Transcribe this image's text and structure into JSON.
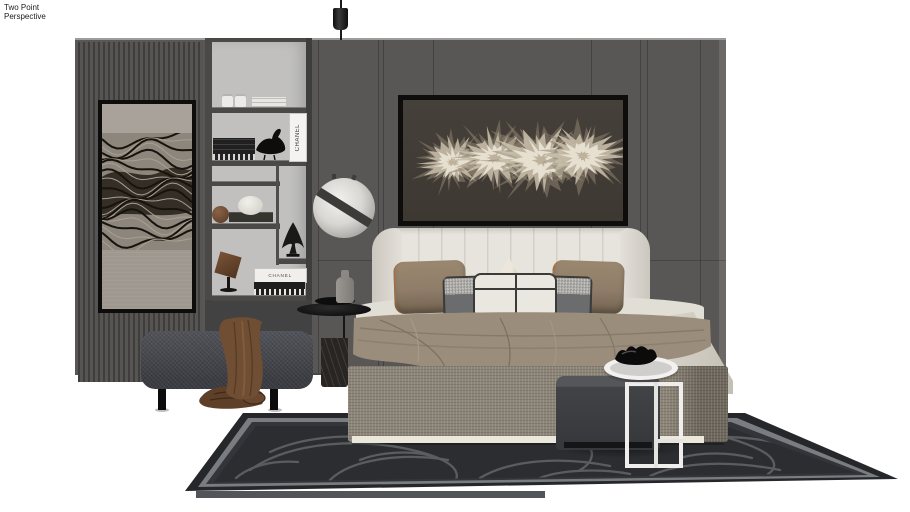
{
  "camera_label": {
    "line1": "Two Point",
    "line2": "Perspective"
  },
  "decor_text": {
    "book_spine_vertical": "CHANEL",
    "book_stack_spine": "CHANEL"
  },
  "palette": {
    "floor": "#ffffff",
    "wall": "#585756",
    "wall_edge": "#6b6a69",
    "rib_dark": "#3f3e3d",
    "rib_light": "#565554",
    "shelf_back": "#c1c0bf",
    "shelf_frame": "#4a4948",
    "art_frame": "#0e0d0c",
    "art_bg": "#3e3832",
    "art_petal_outer": "#8e8270",
    "art_petal_mid": "#c9bfab",
    "art_petal_core": "#e9e2d2",
    "headboard": "#e7e4dd",
    "pillow_brown": "#8f7d69",
    "pillow_gray": "#6a6c6d",
    "pillow_check": "#b7b6b2",
    "lumbar": "#eae7e0",
    "piping": "#3a3a39",
    "sheet": "#e1ded6",
    "blanket": "#9a8d7c",
    "base": "#8d8577",
    "base_trim": "#ece7db",
    "bench": "#474950",
    "throw": "#6f4e34",
    "marble": "#292522",
    "rug_field": "#2c2d30",
    "rug_border": "#7a7d80",
    "rug_edge": "#26272a",
    "rug_pattern": "#5d6064",
    "pouf": "#414346",
    "white_table": "#efeeec",
    "globe": "#d9d7d3",
    "label": "#1c1c1c"
  }
}
